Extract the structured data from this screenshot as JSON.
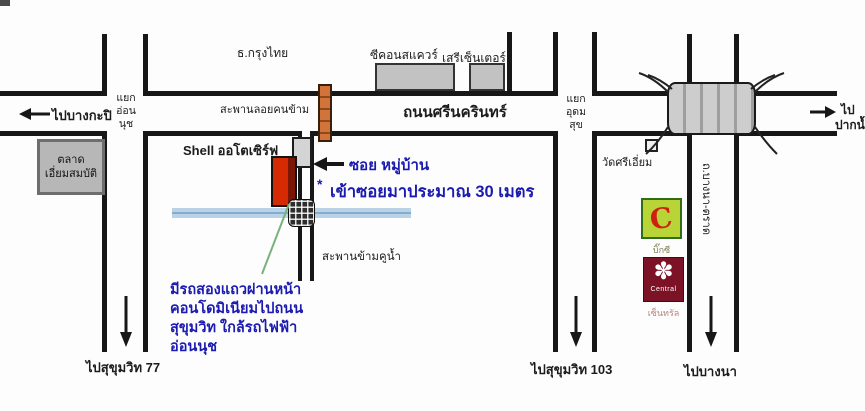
{
  "roads": {
    "srinakarin": "ถนนศรีนครินทร์",
    "bangna_trat": "ถ.บางนา-ตราด",
    "pedestrian_overpass": "สะพานลอยคนข้าม",
    "canal_bridge": "สะพานข้ามคูน้ำ"
  },
  "directions": {
    "to_bangkapi": "ไปบางกะปิ",
    "to_paknam_line1": "ไป",
    "to_paknam_line2": "ปากน้ำ",
    "to_sukhumvit_77": "ไปสุขุมวิท 77",
    "to_sukhumvit_103": "ไปสุขุมวิท 103",
    "to_bangna": "ไปบางนา"
  },
  "intersections": {
    "on_nut": [
      "แยก",
      "อ่อน",
      "นุช"
    ],
    "udom_suk": [
      "แยก",
      "อุดม",
      "สุข"
    ]
  },
  "places": {
    "krungthai_bank": "ธ.กรุงไทย",
    "seacon_square": "ซีคอนสแควร์",
    "seri_center": "เสรีเซ็นเตอร์",
    "market_line1": "ตลาด",
    "market_line2": "เอี่ยมสมบัติ",
    "shell_station": "Shell ออโตเซิร์ฟ",
    "wat_sri_iam": "วัดศรีเอี่ยม",
    "big_c": {
      "logo": "C",
      "caption": "บิ๊กซี"
    },
    "central": {
      "logo_glyph": "✽",
      "logo_text": "Central",
      "caption": "เซ็นทรัล"
    }
  },
  "annotations": {
    "soi": "ซอย หมู่บ้าน",
    "soi_note_mark": "*",
    "soi_note": "เข้าซอยมาประมาณ 30 เมตร",
    "songthaew_note_line1": "มีรถสองแถวผ่านหน้า",
    "songthaew_note_line2": "คอนโดมิเนียมไปถนน",
    "songthaew_note_line3": "สุขุมวิท ใกล้รถไฟฟ้า",
    "songthaew_note_line4": "อ่อนนุช"
  },
  "colors": {
    "road_line": "#171717",
    "note_blue": "#1b1bb0",
    "condo_red": "#d52a02",
    "footbridge_orange": "#d2743a",
    "canal_blue": "#b9d2e8",
    "big_c_green": "#b8d437",
    "central_maroon": "#7c1226"
  }
}
